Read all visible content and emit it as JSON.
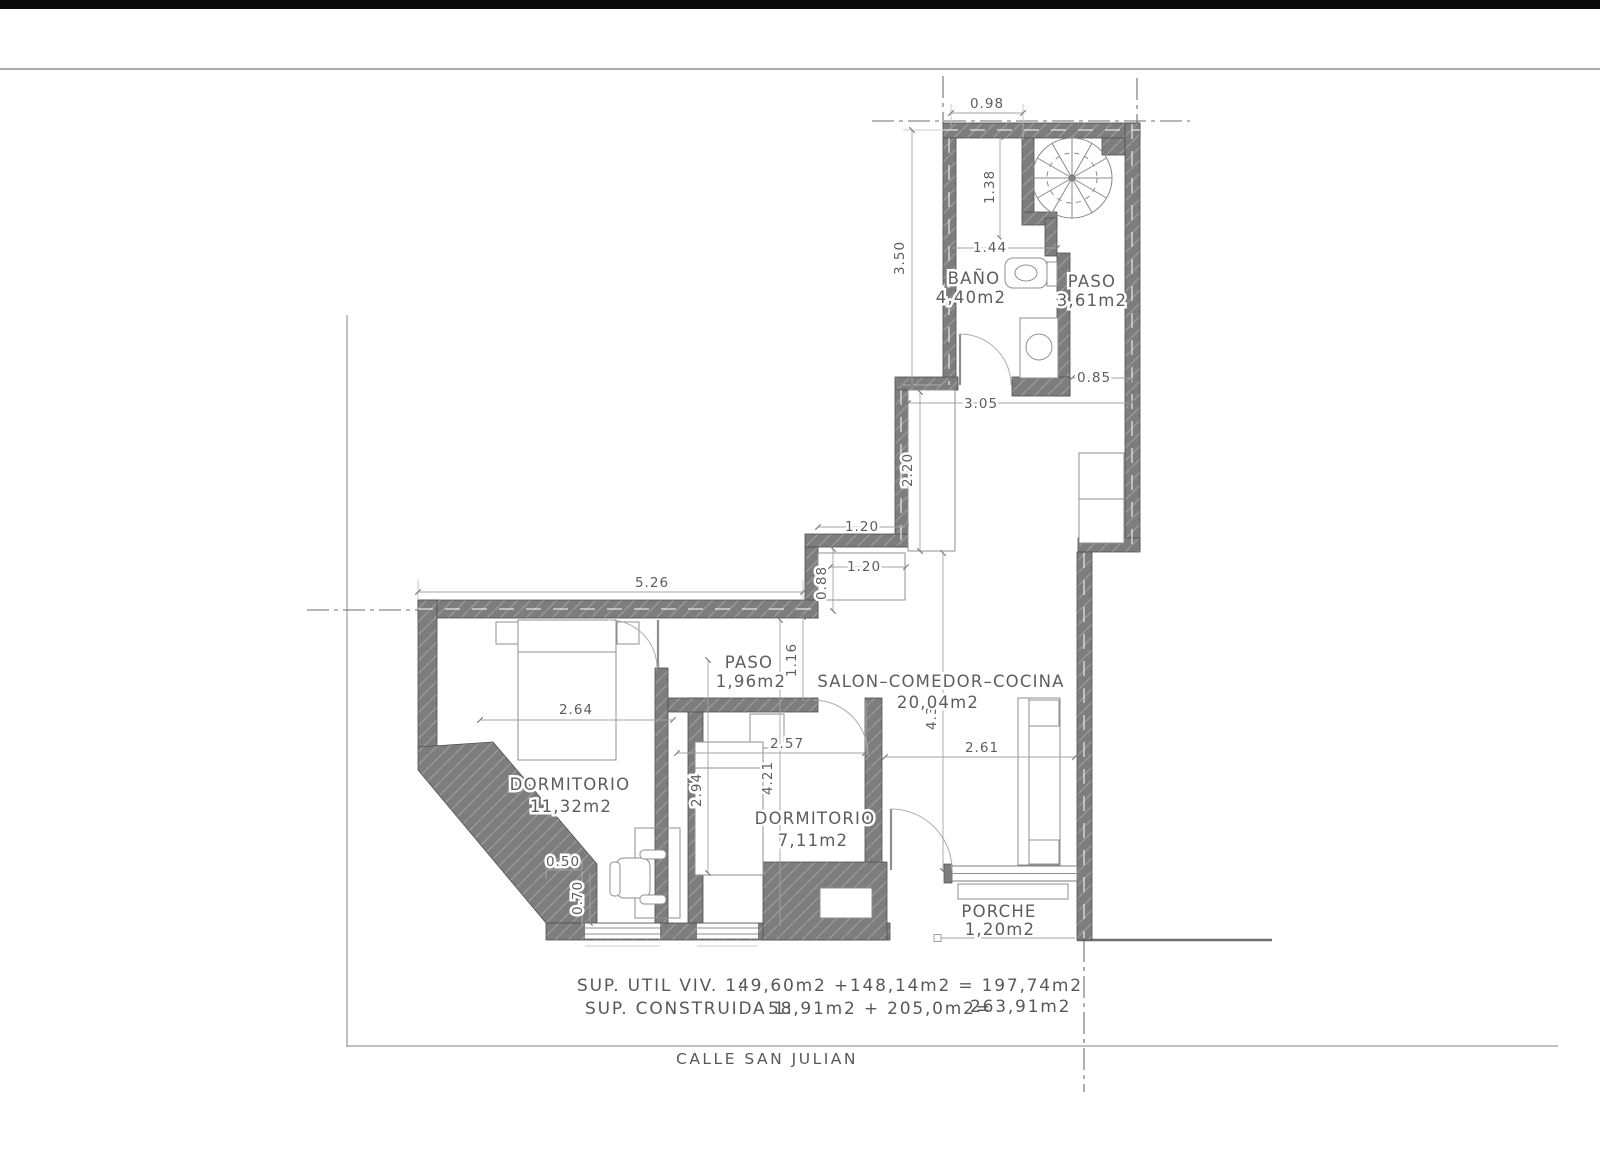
{
  "street": "CALLE SAN JULIAN",
  "summary": {
    "line1_label": "SUP. UTIL VIV. 1:",
    "line1_values": "49,60m2 +148,14m2 = 197,74m2",
    "line2_label": "SUP. CONSTRUIDA 1:",
    "line2_values": "58,91m2 + 205,0m2=",
    "line2_total": "263,91m2"
  },
  "rooms": {
    "bano": {
      "name": "BAÑO",
      "area": "4,40m2"
    },
    "paso_upper": {
      "name": "PASO",
      "area": "3,61m2"
    },
    "salon": {
      "name": "SALON–COMEDOR–COCINA",
      "area": "20,04m2"
    },
    "paso_lower": {
      "name": "PASO",
      "area": "1,96m2"
    },
    "dorm1": {
      "name": "DORMITORIO",
      "area": "11,32m2"
    },
    "dorm2": {
      "name": "DORMITORIO",
      "area": "7,11m2"
    },
    "porche": {
      "name": "PORCHE",
      "area": "1,20m2"
    }
  },
  "dims": {
    "top_width": "0.98",
    "stair_depth": "1.38",
    "bano_height": "3.50",
    "bano_width": "1.44",
    "paso_pass": "0.85",
    "salon_top": "3.05",
    "counter_len": "2.20",
    "jog_w1": "1.20",
    "jog_w2": "1.20",
    "jog_h": "0.88",
    "paso_open": "1.16",
    "dorm1_top": "5.26",
    "bed_width": "2.64",
    "dorm1_height": "4.21",
    "dorm2_height": "2.94",
    "dorm2_width": "2.57",
    "salon_width": "2.61",
    "salon_height": "4.35",
    "wall_thick": "0.50",
    "win_offset": "0.70"
  },
  "colors": {
    "wall": "#7d7d7d",
    "line": "#9b9b9b",
    "text": "#5d5d5d",
    "topbar": "#0a0a0a"
  }
}
